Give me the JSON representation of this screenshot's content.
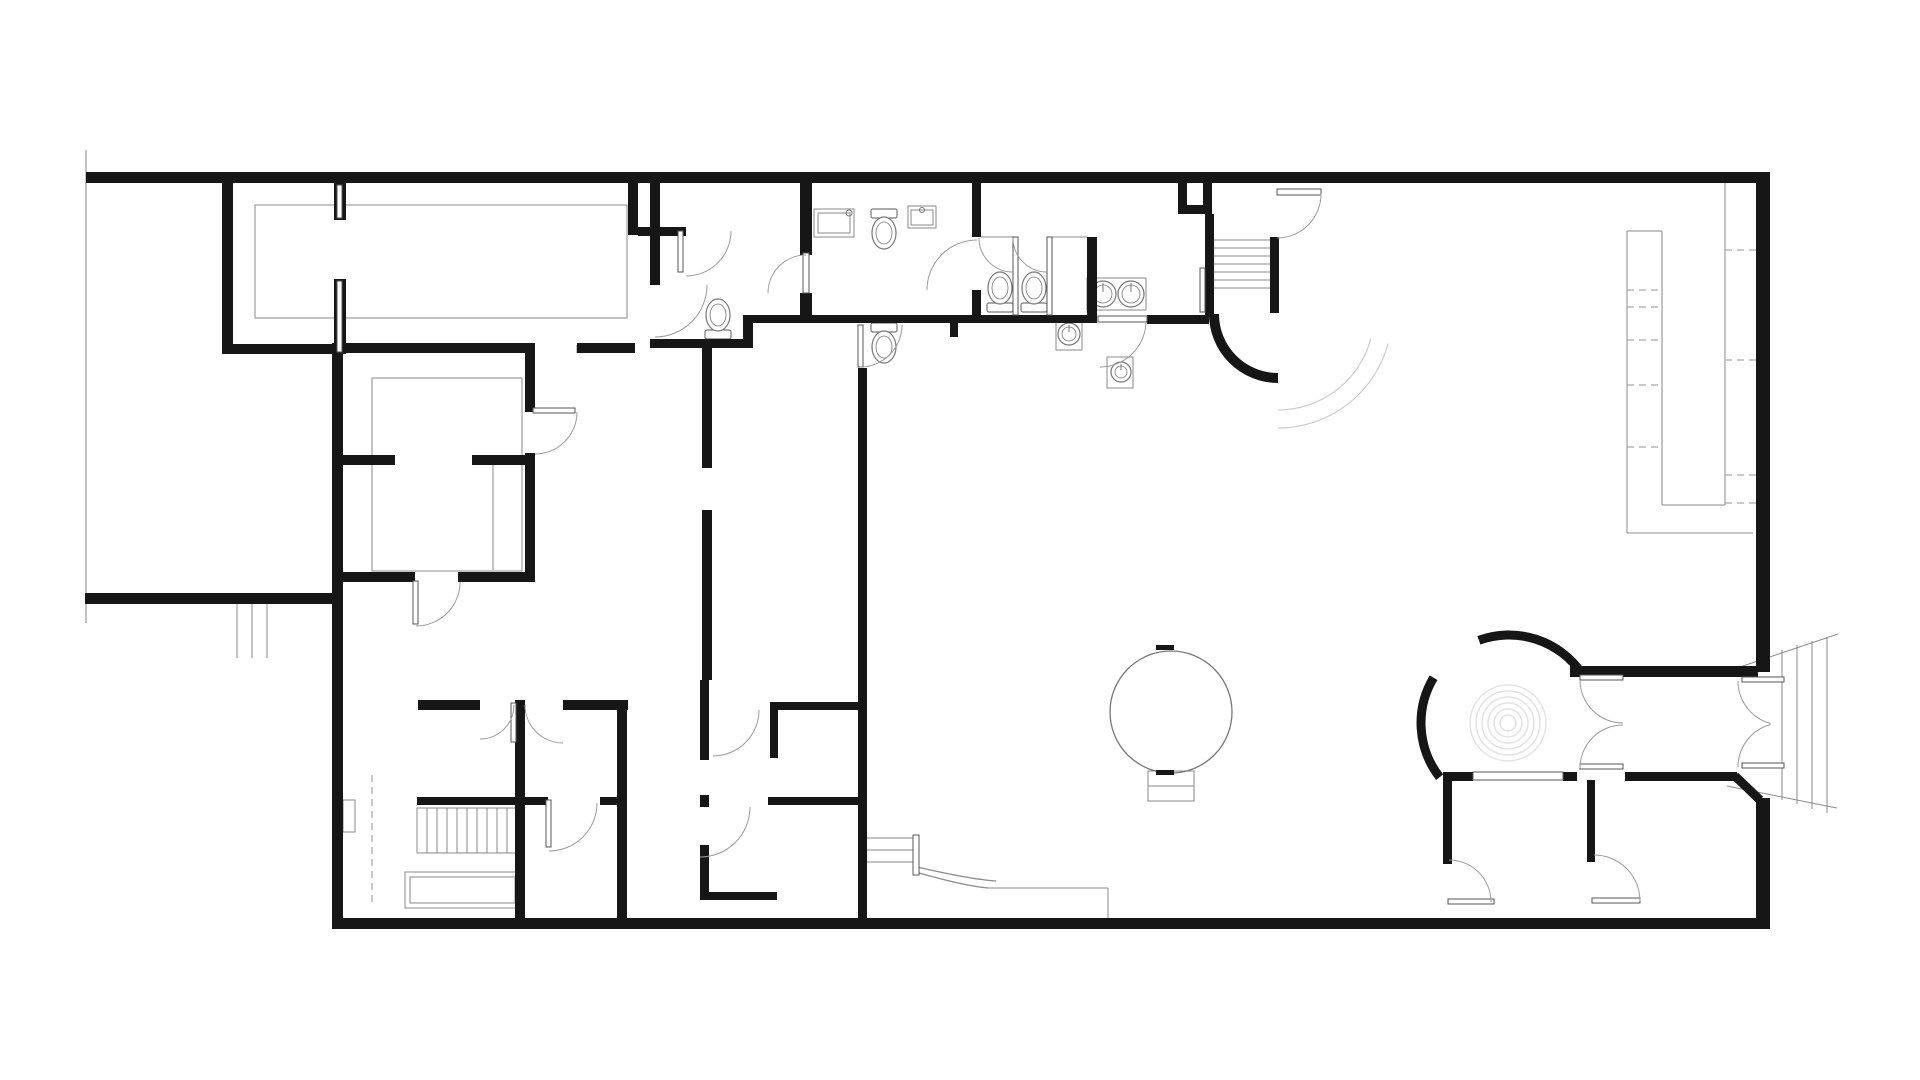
{
  "meta": {
    "canvas": {
      "w": 1920,
      "h": 1080
    },
    "colors": {
      "bg": "#ffffff",
      "wall": "#161616",
      "door_arc": "#9a9a9a",
      "detail": "#8a8a8a",
      "dashed": "#aaaaaa",
      "fixture": "#777777",
      "deco": "#cccccc",
      "spiral": "#e2e2e2",
      "leaf_edge": "#555555"
    }
  },
  "plan": {
    "walls": [
      [
        86,
        172,
        1684,
        11
      ],
      [
        1756,
        172,
        14,
        500
      ],
      [
        1756,
        798,
        14,
        131
      ],
      [
        335,
        918,
        1435,
        11
      ],
      [
        332,
        343,
        11,
        586
      ],
      [
        85,
        593,
        250,
        11
      ],
      [
        222,
        183,
        11,
        167
      ],
      [
        222,
        344,
        113,
        10
      ],
      [
        334,
        183,
        12,
        37
      ],
      [
        334,
        279,
        12,
        75
      ],
      [
        342,
        343,
        191,
        10
      ],
      [
        577,
        343,
        58,
        10
      ],
      [
        628,
        183,
        10,
        52
      ],
      [
        638,
        227,
        48,
        9
      ],
      [
        650,
        183,
        10,
        102
      ],
      [
        650,
        339,
        100,
        9
      ],
      [
        743,
        315,
        10,
        33
      ],
      [
        753,
        315,
        344,
        8
      ],
      [
        800,
        183,
        12,
        72
      ],
      [
        800,
        293,
        12,
        30
      ],
      [
        972,
        183,
        9,
        54
      ],
      [
        972,
        290,
        9,
        25
      ],
      [
        1087,
        237,
        10,
        80
      ],
      [
        950,
        323,
        8,
        14
      ],
      [
        1147,
        315,
        62,
        9
      ],
      [
        1178,
        183,
        9,
        31
      ],
      [
        1178,
        205,
        34,
        9
      ],
      [
        1203,
        183,
        9,
        31
      ],
      [
        1205,
        214,
        9,
        103
      ],
      [
        1270,
        237,
        9,
        76
      ],
      [
        1570,
        666,
        188,
        11
      ],
      [
        1443,
        772,
        30,
        9
      ],
      [
        1563,
        772,
        14,
        9
      ],
      [
        1625,
        772,
        112,
        9
      ],
      [
        1443,
        780,
        9,
        84
      ],
      [
        1587,
        780,
        8,
        82
      ],
      [
        515,
        700,
        10,
        218
      ],
      [
        418,
        700,
        62,
        10
      ],
      [
        563,
        700,
        65,
        10
      ],
      [
        617,
        700,
        10,
        218
      ],
      [
        417,
        797,
        131,
        8
      ],
      [
        600,
        797,
        27,
        8
      ],
      [
        700,
        680,
        9,
        80
      ],
      [
        700,
        795,
        9,
        12
      ],
      [
        700,
        845,
        9,
        55
      ],
      [
        770,
        702,
        93,
        8
      ],
      [
        770,
        702,
        8,
        56
      ],
      [
        768,
        797,
        90,
        8
      ],
      [
        700,
        892,
        77,
        8
      ],
      [
        858,
        368,
        9,
        551
      ],
      [
        702,
        348,
        10,
        120
      ],
      [
        702,
        510,
        10,
        170
      ],
      [
        342,
        455,
        53,
        10
      ],
      [
        472,
        455,
        53,
        10
      ],
      [
        525,
        343,
        10,
        69
      ],
      [
        525,
        453,
        10,
        129
      ],
      [
        342,
        572,
        73,
        10
      ],
      [
        458,
        572,
        75,
        10
      ]
    ],
    "wall_lines": [
      [
        1735,
        776,
        1760,
        800,
        9
      ]
    ],
    "wall_arcs": [
      [
        1278,
        314,
        64,
        90,
        180,
        10
      ],
      [
        1509,
        723,
        88,
        250,
        326,
        9
      ],
      [
        1509,
        723,
        88,
        142,
        211,
        9
      ]
    ],
    "door_arcs": [
      [
        686,
        231,
        45,
        0,
        90
      ],
      [
        655,
        285,
        52,
        0,
        90
      ],
      [
        806,
        293,
        38,
        180,
        270
      ],
      [
        977,
        290,
        50,
        180,
        270
      ],
      [
        1013,
        238,
        34,
        90,
        180
      ],
      [
        1047,
        238,
        34,
        90,
        180
      ],
      [
        1100,
        321,
        46,
        0,
        90
      ],
      [
        1277,
        194,
        44,
        0,
        90
      ],
      [
        860,
        325,
        42,
        0,
        90
      ],
      [
        480,
        705,
        34,
        0,
        90
      ],
      [
        563,
        705,
        38,
        90,
        180
      ],
      [
        549,
        803,
        48,
        0,
        90
      ],
      [
        700,
        807,
        50,
        0,
        90
      ],
      [
        713,
        710,
        46,
        0,
        90
      ],
      [
        416,
        582,
        44,
        0,
        90
      ],
      [
        535,
        412,
        42,
        0,
        90
      ],
      [
        1449,
        902,
        42,
        270,
        360
      ],
      [
        1594,
        901,
        46,
        270,
        360
      ],
      [
        1623,
        680,
        43,
        90,
        180
      ],
      [
        1623,
        768,
        43,
        180,
        270
      ],
      [
        1782,
        681,
        44,
        105,
        180
      ],
      [
        1782,
        767,
        44,
        180,
        255
      ]
    ],
    "deco_arcs": [
      [
        1278,
        314,
        96,
        15,
        90
      ],
      [
        1278,
        314,
        114,
        15,
        90
      ]
    ],
    "leaves": [
      [
        678,
        231,
        5,
        41
      ],
      [
        803,
        253,
        6,
        40
      ],
      [
        1098,
        316,
        49,
        6
      ],
      [
        1277,
        189,
        44,
        6
      ],
      [
        511,
        703,
        5,
        39
      ],
      [
        546,
        800,
        5,
        47
      ],
      [
        413,
        581,
        5,
        43
      ],
      [
        533,
        408,
        42,
        5
      ],
      [
        858,
        325,
        5,
        42
      ],
      [
        1448,
        899,
        46,
        5
      ],
      [
        1592,
        898,
        48,
        5
      ],
      [
        1580,
        675,
        43,
        5
      ],
      [
        1580,
        764,
        43,
        5
      ],
      [
        1742,
        677,
        42,
        5
      ],
      [
        1742,
        763,
        42,
        5
      ],
      [
        1200,
        268,
        5,
        44
      ],
      [
        1473,
        772,
        90,
        8
      ],
      [
        1013,
        237,
        5,
        78
      ],
      [
        1047,
        237,
        5,
        78
      ],
      [
        337,
        185,
        5,
        33
      ],
      [
        337,
        281,
        5,
        71
      ],
      [
        913,
        835,
        6,
        40
      ]
    ],
    "thin_lines": [
      [
        1725,
        183,
        1725,
        505
      ],
      [
        1627,
        231,
        1627,
        533
      ],
      [
        1662,
        231,
        1662,
        505
      ],
      [
        1627,
        231,
        1662,
        231
      ],
      [
        1662,
        505,
        1725,
        505
      ],
      [
        1627,
        533,
        1753,
        533
      ],
      [
        86,
        150,
        86,
        623
      ],
      [
        237,
        604,
        237,
        658
      ],
      [
        252,
        604,
        252,
        658
      ],
      [
        267,
        604,
        267,
        658
      ],
      [
        865,
        838,
        913,
        838
      ],
      [
        865,
        850,
        913,
        850
      ],
      [
        865,
        862,
        913,
        862
      ],
      [
        988,
        888,
        1108,
        888
      ],
      [
        1108,
        888,
        1108,
        918
      ],
      [
        1737,
        668,
        1838,
        634
      ],
      [
        1727,
        786,
        1837,
        808
      ],
      [
        1782,
        650,
        1782,
        800
      ],
      [
        1797,
        645,
        1797,
        804
      ],
      [
        1812,
        641,
        1812,
        809
      ],
      [
        1827,
        637,
        1827,
        813
      ],
      [
        981,
        237,
        1013,
        237
      ],
      [
        1052,
        237,
        1087,
        237
      ],
      [
        493,
        465,
        493,
        570
      ],
      [
        1148,
        786,
        1194,
        786
      ],
      [
        1214,
        240,
        1270,
        240
      ],
      [
        1214,
        248,
        1270,
        248
      ],
      [
        1214,
        256,
        1270,
        256
      ],
      [
        1214,
        264,
        1270,
        264
      ],
      [
        1214,
        272,
        1270,
        272
      ],
      [
        1214,
        280,
        1270,
        280
      ],
      [
        1214,
        288,
        1270,
        288
      ],
      [
        533,
        345,
        533,
        353
      ],
      [
        577,
        345,
        577,
        353
      ],
      [
        427,
        808,
        427,
        853
      ],
      [
        437,
        808,
        437,
        853
      ],
      [
        447,
        808,
        447,
        853
      ],
      [
        457,
        808,
        457,
        853
      ],
      [
        467,
        808,
        467,
        853
      ],
      [
        477,
        808,
        477,
        853
      ],
      [
        487,
        808,
        487,
        853
      ],
      [
        497,
        808,
        497,
        853
      ],
      [
        507,
        808,
        507,
        853
      ]
    ],
    "dashed_lines": [
      [
        372,
        775,
        372,
        905
      ],
      [
        1627,
        290,
        1662,
        290
      ],
      [
        1627,
        307,
        1662,
        307
      ],
      [
        1627,
        340,
        1662,
        340
      ],
      [
        1627,
        385,
        1662,
        385
      ],
      [
        1627,
        447,
        1662,
        447
      ],
      [
        1725,
        250,
        1756,
        250
      ],
      [
        1725,
        360,
        1756,
        360
      ],
      [
        1725,
        475,
        1756,
        475
      ],
      [
        1725,
        503,
        1756,
        503
      ]
    ],
    "rects_thin": [
      [
        255,
        205,
        372,
        113
      ],
      [
        372,
        378,
        150,
        193
      ],
      [
        417,
        808,
        100,
        45
      ],
      [
        405,
        872,
        115,
        36
      ],
      [
        410,
        877,
        105,
        26
      ],
      [
        1148,
        771,
        46,
        30
      ],
      [
        343,
        800,
        12,
        32
      ],
      [
        814,
        209,
        40,
        28
      ],
      [
        818,
        213,
        32,
        20
      ],
      [
        908,
        206,
        28,
        22
      ],
      [
        911,
        210,
        22,
        15
      ],
      [
        1087,
        278,
        59,
        32
      ],
      [
        1056,
        319,
        26,
        31
      ],
      [
        1107,
        357,
        26,
        31
      ]
    ],
    "curves": [
      "M919,873 Q965,886 988,888",
      "M913,866 Q968,879 996,881"
    ],
    "toilets": [
      {
        "cx": 718,
        "wallY": 339,
        "dir": "up"
      },
      {
        "cx": 884,
        "wallY": 209,
        "dir": "down"
      },
      {
        "cx": 884,
        "wallY": 323,
        "dir": "down"
      },
      {
        "cx": 1000,
        "wallY": 312,
        "dir": "up"
      },
      {
        "cx": 1034,
        "wallY": 312,
        "dir": "up"
      }
    ],
    "sinks_round": [
      [
        1103,
        294,
        13
      ],
      [
        1131,
        294,
        13
      ],
      [
        1069,
        334,
        11
      ],
      [
        1121,
        372,
        10
      ]
    ],
    "dots": [
      [
        849,
        213,
        3
      ],
      [
        922,
        210,
        2.5
      ]
    ],
    "globe": {
      "cx": 1171,
      "cy": 712,
      "r": 61
    },
    "ticks": [
      [
        1156,
        645,
        18,
        5
      ],
      [
        1156,
        770,
        18,
        5
      ]
    ],
    "spiral": {
      "cx": 1508,
      "cy": 723,
      "radii": [
        8,
        14,
        20,
        26,
        32,
        38
      ]
    }
  }
}
